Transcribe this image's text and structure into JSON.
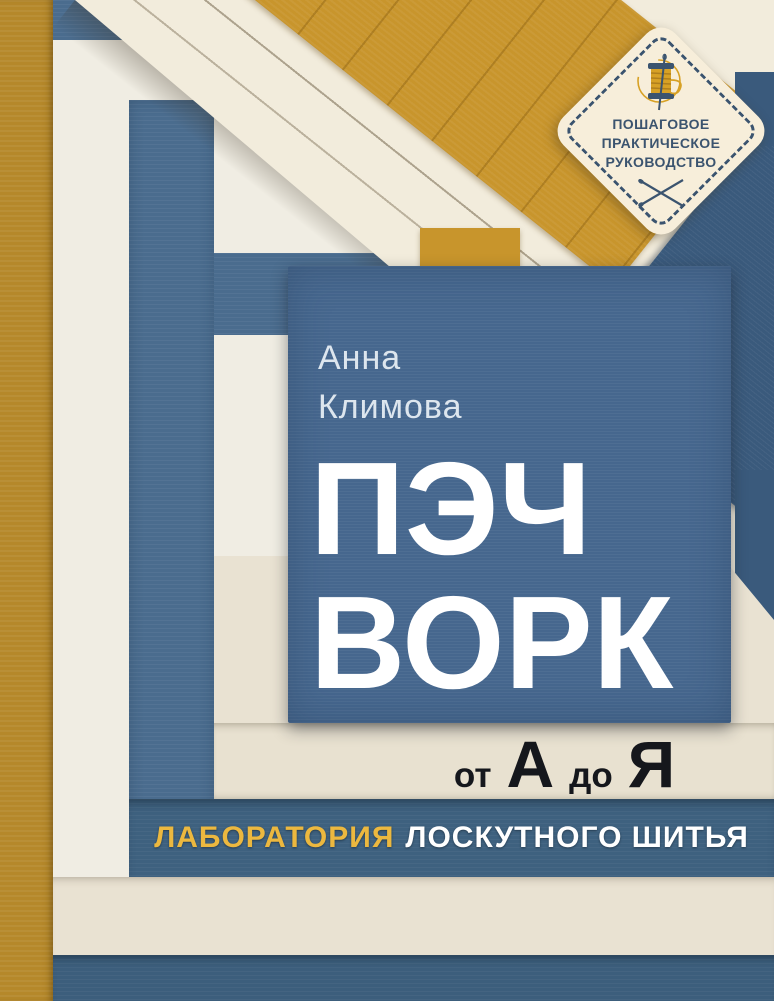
{
  "cover": {
    "badge": {
      "lines": [
        "ПОШАГОВОЕ",
        "ПРАКТИЧЕСКОЕ",
        "РУКОВОДСТВО"
      ],
      "icons": [
        "thread-spool-icon",
        "crossed-needles-icon"
      ]
    },
    "author": {
      "line1": "Анна",
      "line2": "Климова"
    },
    "title": {
      "line1": "ПЭЧ",
      "line2": "ВОРК"
    },
    "subtitle": {
      "word1": "от",
      "letter1": "А",
      "word2": "до",
      "letter2": "Я"
    },
    "tagline": {
      "highlight": "ЛАБОРАТОРИЯ",
      "rest": "ЛОСКУТНОГО ШИТЬЯ"
    }
  },
  "colors": {
    "mustard_binding": "#b5882a",
    "mustard": "#c8952c",
    "cream_base": "#f0ede3",
    "cream_warm": "#e9e2d2",
    "cream_band": "#e8e1d0",
    "cream_fold": "#f2ecdc",
    "navy_frame": "#4a6c8e",
    "navy_band": "#3e617f",
    "navy_deep": "#3c5e7c",
    "navy_panel": "#46678e",
    "navy_fold": "#3a5a7c",
    "badge_bg": "#f7eeda",
    "badge_navy": "#3b546f",
    "spool_gold": "#d7a125",
    "gold_text": "#ecb83f",
    "ink": "#15171c",
    "white_text": "#ffffff",
    "author_text": "#dde6ee"
  }
}
